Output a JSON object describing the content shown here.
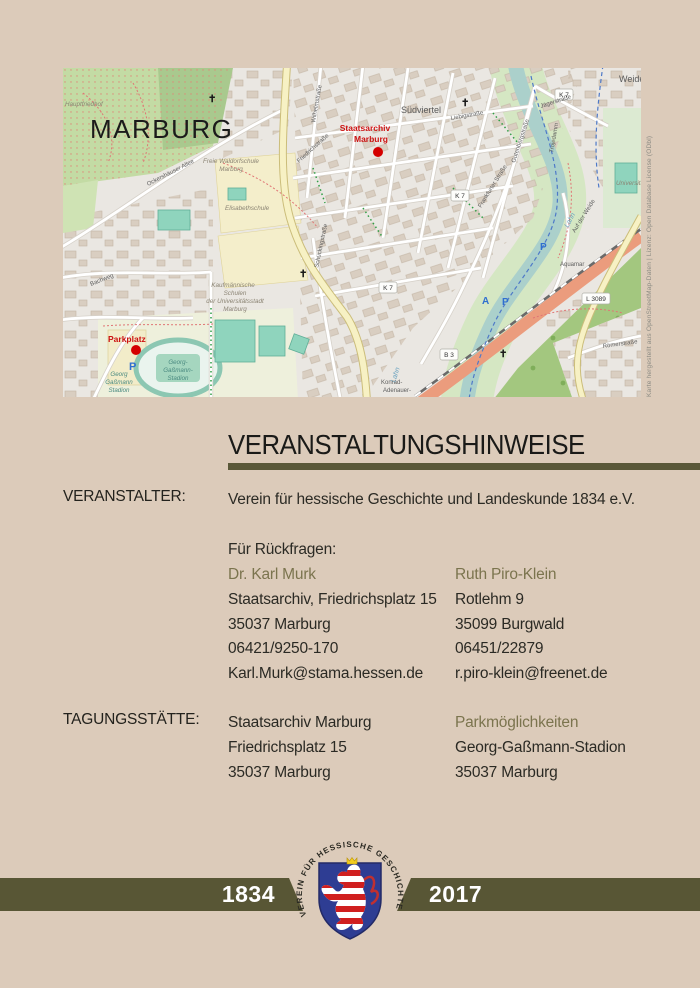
{
  "colors": {
    "background": "#dccbba",
    "bar_olive": "#585635",
    "olive_text": "#7b744e",
    "marker_red": "#cc1111",
    "shield_blue": "#2e3d93"
  },
  "map": {
    "attribution": "Karte hergestellt aus OpenStreetMap-Daten | Lizenz: Open Database License (ODbl)",
    "city": "MARBURG",
    "labels": {
      "hauptfriedhof": "Hauptfriedhof",
      "waldorf_l1": "Freie Waldorfschule",
      "waldorf_l2": "Marburg",
      "elisabethschule": "Elisabethschule",
      "suedviertel": "Südviertel",
      "staatsarchiv_l1": "Staatsarchiv",
      "staatsarchiv_l2": "Marburg",
      "parkplatz": "Parkplatz",
      "georg_l1": "Georg",
      "georg_l2": "Gaßmann",
      "georg_l3": "Stadion",
      "stadion_l1": "Georg-",
      "stadion_l2": "Gaßmann-",
      "stadion_l3": "Stadion",
      "kauf_l1": "Kaufmännische",
      "kauf_l2": "Schulen",
      "kauf_l3": "der Universitätsstadt",
      "kauf_l4": "Marburg",
      "ockershaeuser": "Ockershäuser Allee",
      "wilhelmstr": "Wilhelmstraße",
      "friedrichstr": "Friedrichstraße",
      "liebigstr": "Liebigstraße",
      "jaegerstr": "Jägerstraße",
      "frankfurter": "Frankfurter Straße",
      "gutenbergstr": "Gutenbergstraße",
      "auf_der_weide": "Auf der Weide",
      "weide": "Weide",
      "universitaet": "Universität",
      "lahn": "Lahn",
      "trojedamm": "Trojedamm",
      "aquamar": "Aquamar",
      "roemerstr": "Römerstraße",
      "konrad_l1": "Konrad-",
      "konrad_l2": "Adenauer-",
      "bachweg": "Bachweg",
      "schueckingstr": "Schückingstraße",
      "badge_k7": "K 7",
      "badge_b3": "B 3",
      "badge_l3089": "L 3089",
      "camp_a": "A",
      "parking_p": "P",
      "cross": "✝"
    }
  },
  "title": "VERANSTALTUNGSHINWEISE",
  "veranstalter": {
    "label": "VERANSTALTER:",
    "value": "Verein für hessische Geschichte und Landeskunde 1834 e.V."
  },
  "rueckfragen": {
    "heading": "Für Rückfragen:",
    "contact1": {
      "name": "Dr. Karl Murk",
      "address": "Staatsarchiv, Friedrichsplatz 15",
      "city": "35037 Marburg",
      "phone": "06421/9250-170",
      "email": "Karl.Murk@stama.hessen.de"
    },
    "contact2": {
      "name": "Ruth Piro-Klein",
      "address": "Rotlehm 9",
      "city": "35099 Burgwald",
      "phone": "06451/22879",
      "email": "r.piro-klein@freenet.de"
    }
  },
  "tagungsstaette": {
    "label": "TAGUNGSSTÄTTE:",
    "venue": {
      "name": "Staatsarchiv Marburg",
      "street": "Friedrichsplatz 15",
      "city": "35037 Marburg"
    },
    "parking": {
      "title": "Parkmöglichkeiten",
      "name": "Georg-Gaßmann-Stadion",
      "city": "35037 Marburg"
    }
  },
  "footer": {
    "year_left": "1834",
    "year_right": "2017",
    "seal_text": "VEREIN FÜR HESSISCHE GESCHICHTE UND LANDESKUNDE 1834 E.V. ·"
  }
}
